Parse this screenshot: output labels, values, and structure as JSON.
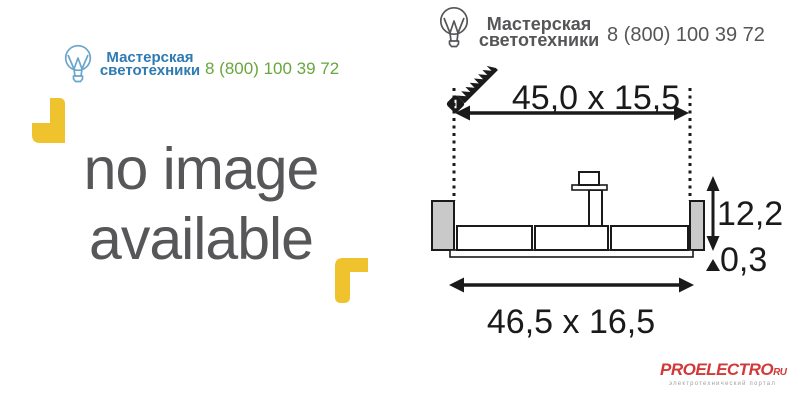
{
  "brand": {
    "name_line1": "Мастерская",
    "name_line2": "светотехники",
    "phone": "8 (800) 100 39 72"
  },
  "left_panel": {
    "placeholder_line1": "no image",
    "placeholder_line2": "available"
  },
  "drawing": {
    "cutout_dimension": "45,0 x 15,5",
    "depth_dimension": "12,2",
    "rim_dimension": "0,3",
    "overall_dimension": "46,5 x 16,5"
  },
  "footer_logo": {
    "part_pro": "PRO",
    "part_electro": "ELECTRO",
    "part_ru": "RU",
    "tagline": "электротехнический портал"
  },
  "icons": {
    "bulb": "light-bulb-logo",
    "saw": "handsaw-cutout-icon",
    "corners": "photo-corner-marks"
  },
  "colors": {
    "brand_blue": "#2e7ab2",
    "bulb_blue": "#6aa5cc",
    "phone_green": "#67a73c",
    "header_gray": "#565659",
    "placeholder_gray": "#57575a",
    "corner_yellow": "#eec32d",
    "drawing_black": "#1a1a1a",
    "fixture_gray": "#c9c9c9",
    "logo_red": "#d23939",
    "tagline_gray": "#a0a0a0"
  }
}
